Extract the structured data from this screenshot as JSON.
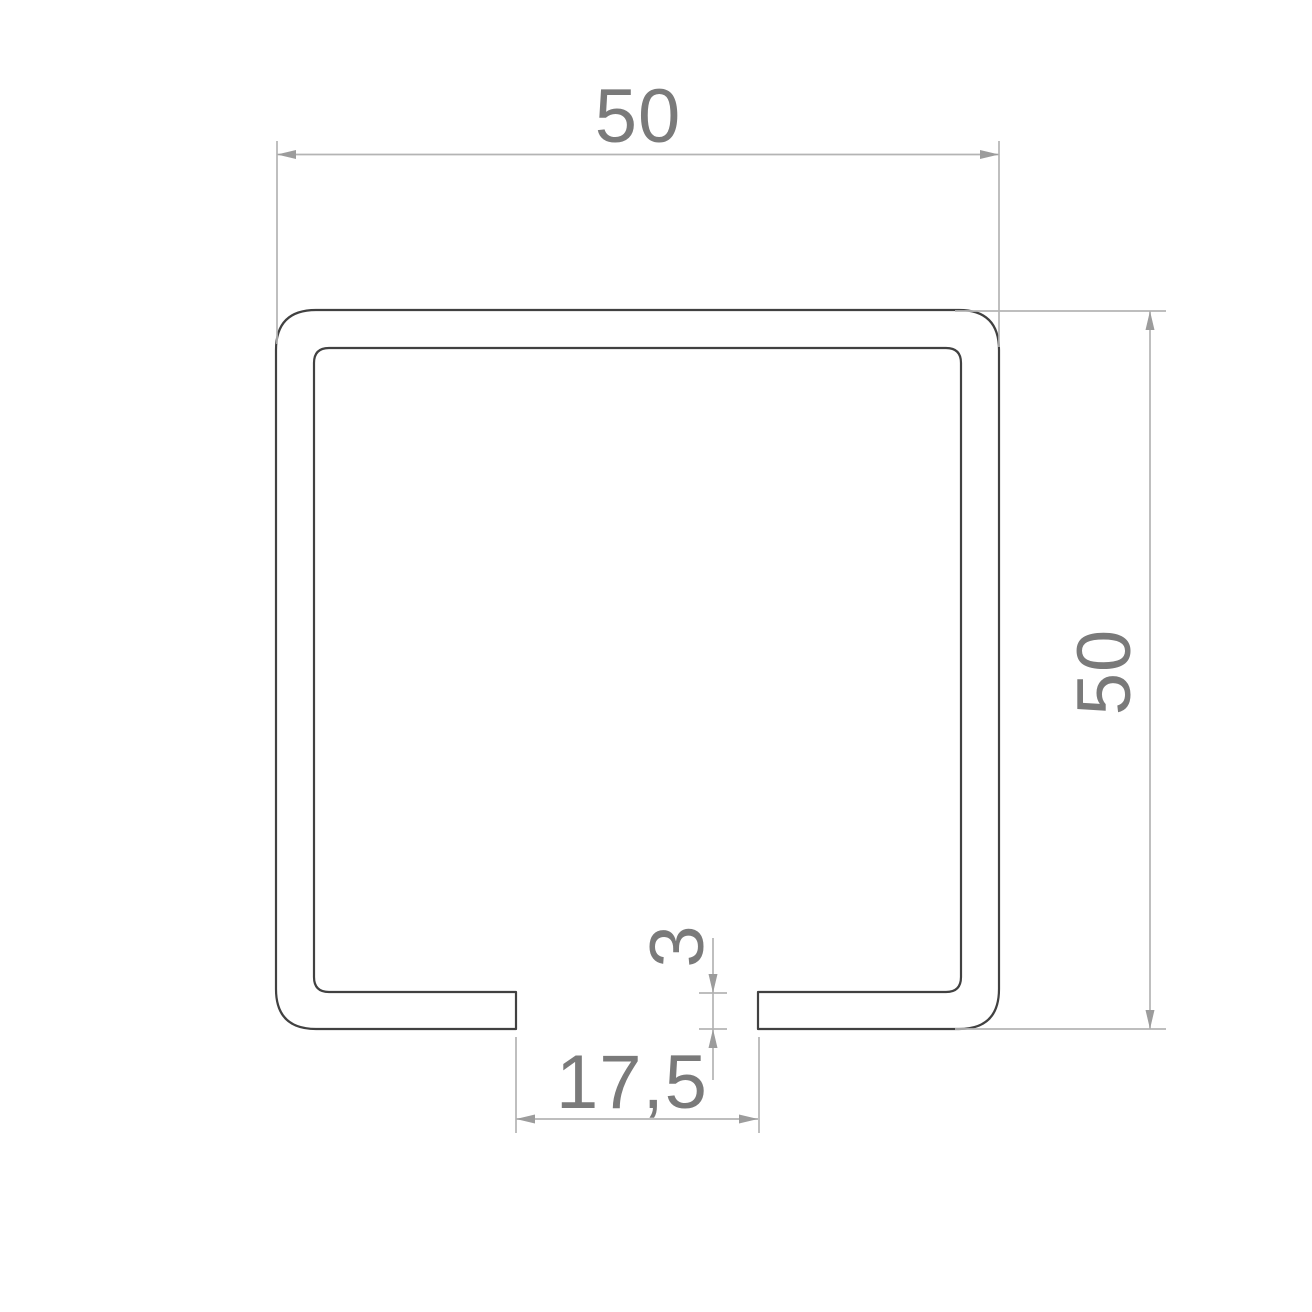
{
  "drawing": {
    "type": "technical-cross-section",
    "dimensions": {
      "top_width": "50",
      "right_height": "50",
      "bottom_gap": "17,5",
      "wall_thickness": "3"
    },
    "colors": {
      "profile_outline": "#414141",
      "dimension_lines": "#b4b4b4",
      "arrowheads": "#9c9c9c",
      "dimension_text": "#7a7a7a",
      "background": "#ffffff"
    }
  }
}
